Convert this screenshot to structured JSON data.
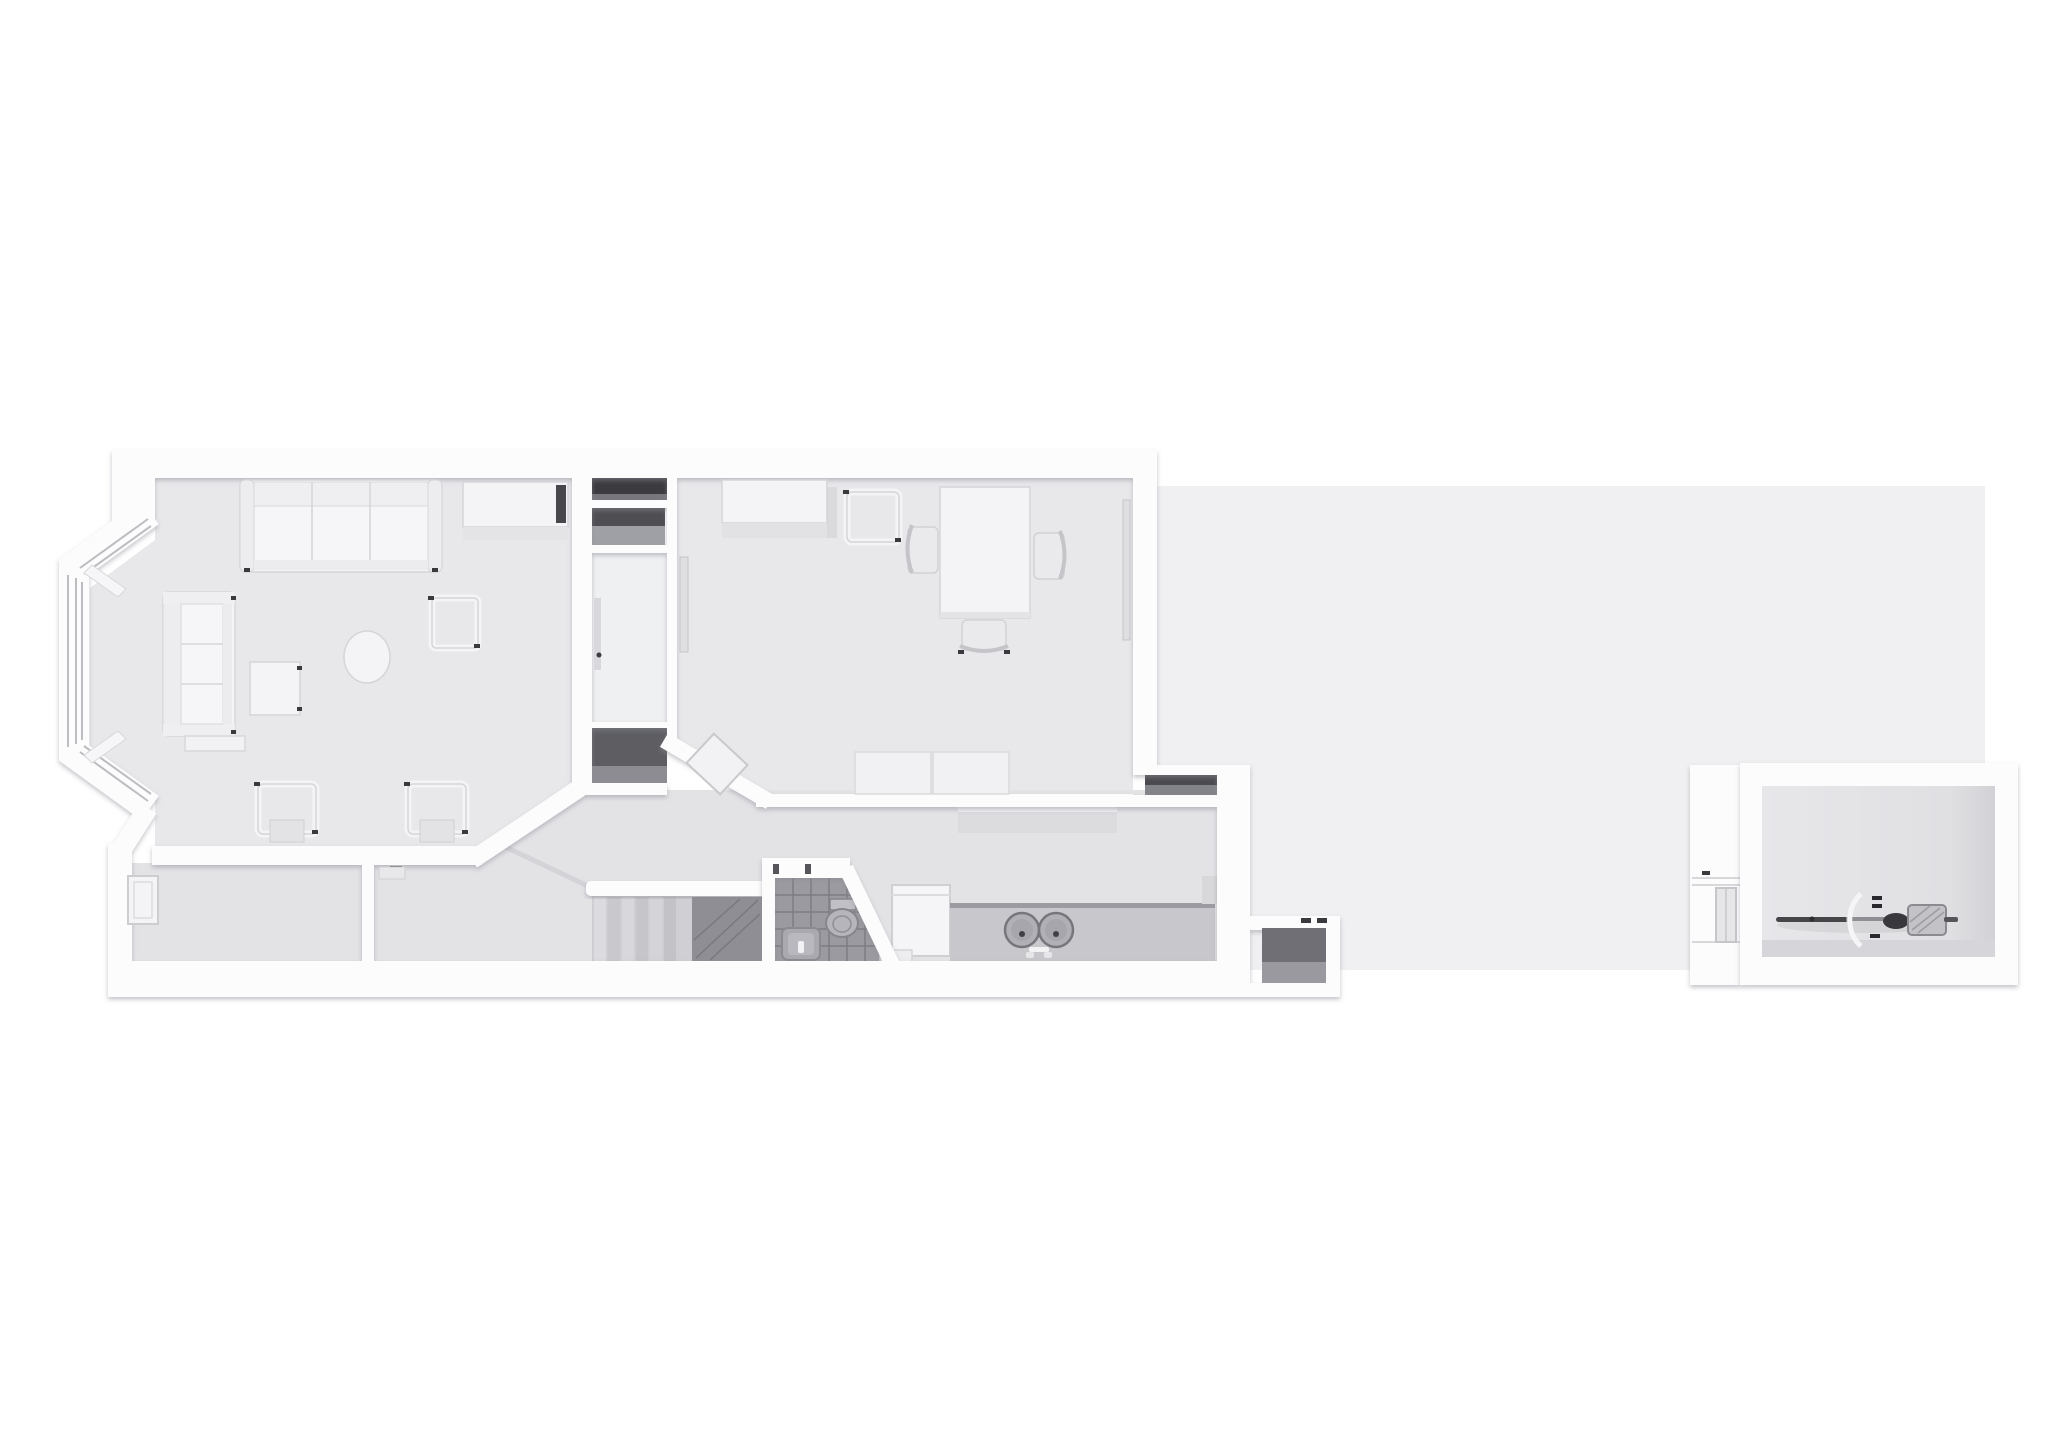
{
  "image_type": "3d-rendered-floor-plan-top-view",
  "text_content": "none — the screenshot contains no visible text, labels or numbers",
  "palette": {
    "background": "#ffffff",
    "wall": "#fcfcfd",
    "wall_shade": "#ececef",
    "floor_main": "#e8e8eb",
    "floor_back": "#e3e3e6",
    "floor_hall": "#eff0f2",
    "garden": "#f0f0f2",
    "shed_floor": "#e2e2e5",
    "tile": "#9a9aa0",
    "tile_line": "#7d7d83",
    "dark_niche": "#4a4a4f",
    "stair_dark": "#8e8e94",
    "counter": "#c7c7cc",
    "fixture": "#b0b0b6",
    "furniture_white": "#f4f4f6",
    "outline": "#d5d5d9",
    "accent_dark": "#3a3a3e",
    "metal": "#8e8e94"
  },
  "plan": {
    "style": "white monochrome architectural render, terraced house ground floor, viewed from directly above",
    "rooms": [
      {
        "name": "living-room",
        "position": "front left, with canted bay window",
        "contents": [
          "three-seat sofa against top wall",
          "sideboard with dark edge",
          "two-seat sofa along bay",
          "ottoman",
          "square coffee table",
          "oval side table",
          "open-frame side table",
          "two open-frame lounge chairs",
          "bay window with three glazed panels and two window sills"
        ]
      },
      {
        "name": "chimney-recess-column",
        "position": "between living and dining room",
        "contents": [
          "dark storage niche",
          "shelved niche",
          "connecting hall with door",
          "under-stair dark cupboard"
        ]
      },
      {
        "name": "dining-room",
        "position": "middle of house",
        "contents": [
          "wardrobe cabinet",
          "open-frame chair",
          "rectangular table",
          "three chairs with curved backs",
          "two-cushion bench against bottom wall",
          "two wall radiators",
          "open door leaf at diagonal corner",
          "external storage niche at bottom-right"
        ]
      },
      {
        "name": "entrance-hallway",
        "position": "bottom strip left, along front corridor",
        "contents": [
          "front door recess in left wall",
          "archway partition stub",
          "radiator",
          "door frame ticks"
        ]
      },
      {
        "name": "staircase",
        "position": "bottom middle",
        "contents": [
          "seven treads",
          "white handrail",
          "dark upper-flight slope",
          "sloped rail along diagonal wall"
        ]
      },
      {
        "name": "bathroom",
        "position": "bottom middle-right with diagonal wall",
        "contents": [
          "dark tiled floor with grid",
          "toilet with cistern",
          "washbasin vanity with tap",
          "door opening at top"
        ]
      },
      {
        "name": "kitchen",
        "position": "bottom right strip of house",
        "contents": [
          "wall shelf",
          "refrigerator appliance",
          "step",
          "long worktop counter",
          "double round sink with taps",
          "counter return"
        ]
      },
      {
        "name": "garden",
        "position": "large light area right of house",
        "contents": []
      },
      {
        "name": "garden-store",
        "position": "small open box attached at bottom of kitchen wall",
        "contents": [
          "dark open interior",
          "lid hinges"
        ]
      },
      {
        "name": "garden-room-shed",
        "position": "detached at far right",
        "contents": [
          "thick white walls",
          "side gate panel with window",
          "bicycle lying horizontally: front wheel, white handlebar arc, pedals, dark saddle, rear basket"
        ]
      }
    ]
  }
}
